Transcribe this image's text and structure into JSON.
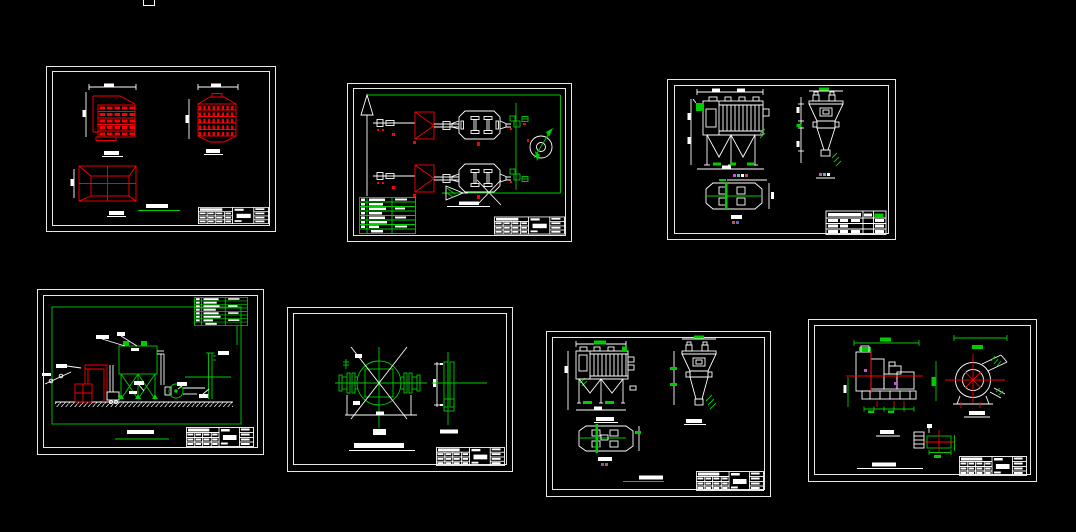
{
  "canvas": {
    "width": 1076,
    "height": 532,
    "background": "#000000"
  },
  "palette": {
    "white": "#ffffff",
    "red": "#fb0000",
    "green": "#00cd00",
    "magenta": "#cc55cc",
    "cyan": "#55bbbb",
    "blue": "#5566bb",
    "darkred": "#bb5555"
  },
  "artifacts": {
    "top_edge_box": "partial white rectangle clipped at top edge of model space"
  },
  "sheets": [
    {
      "id": "sheet-1",
      "aria": "Drawing sheet: red drum component part views (section, front, transition duct) with title block",
      "views": [
        "stepped-housing-section",
        "slatted-drum-front",
        "rectangular-transition"
      ],
      "title_block": true
    },
    {
      "id": "sheet-2",
      "aria": "Drawing sheet: dust collection process flow diagram, two parallel lines with hoppers, collectors and fan, legend table and title block",
      "views": [
        "process-flow-schematic"
      ],
      "legend_rows": 8,
      "title_block": true
    },
    {
      "id": "sheet-3",
      "aria": "Drawing sheet: bag filter dust collector three views (front, side, plan) with title block",
      "views": [
        "front-view",
        "side-view",
        "plan-view"
      ],
      "title_block": true
    },
    {
      "id": "sheet-4",
      "aria": "Drawing sheet: system elevation layout with furnace duct, bag house on braced frame, fan and stack, equipment legend",
      "views": [
        "elevation-layout"
      ],
      "legend_rows": 7,
      "title_block": true
    },
    {
      "id": "sheet-5",
      "aria": "Drawing sheet: flanged butterfly valve front and side views with title block",
      "views": [
        "valve-front-view",
        "valve-side-view"
      ],
      "title_block": true
    },
    {
      "id": "sheet-6",
      "aria": "Drawing sheet: bag filter dust collector three views (front, side, plan) with title block",
      "views": [
        "front-view",
        "side-view",
        "plan-view"
      ],
      "title_block": true
    },
    {
      "id": "sheet-7",
      "aria": "Drawing sheet: centrifugal fan with motor, side and front views plus detail, with title block",
      "views": [
        "fan-side-view",
        "fan-front-view",
        "detail-view"
      ],
      "title_block": true
    }
  ]
}
